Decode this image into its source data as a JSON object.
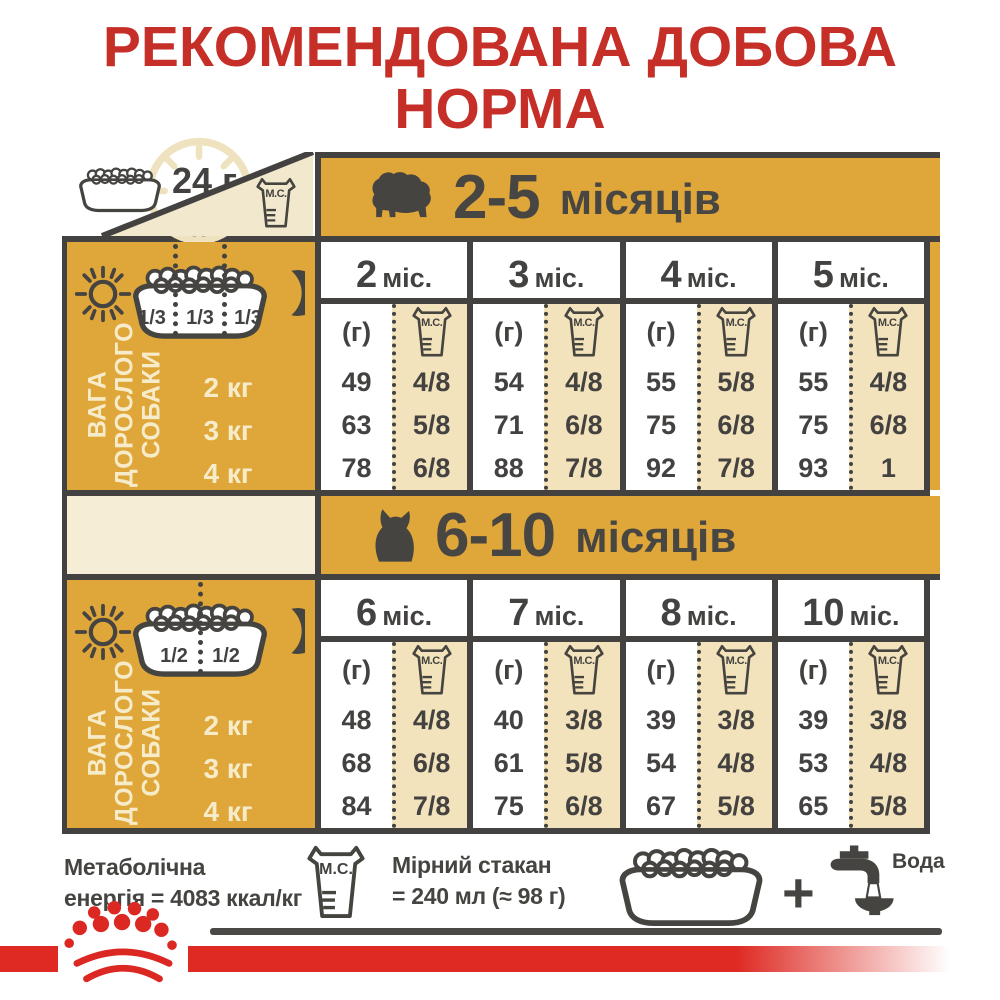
{
  "title": {
    "line1": "РЕКОМЕНДОВАНА ДОБОВА",
    "line2": "НОРМА"
  },
  "top": {
    "daily_label": "24 г"
  },
  "labels": {
    "mc": "М.С.",
    "grams": "(г)"
  },
  "colors": {
    "gold": "#DFA63A",
    "beige": "#F3E3BC",
    "dark": "#434240",
    "red_title": "#C62F28",
    "red_bar": "#DE2A23"
  },
  "sections": [
    {
      "range": "2-5",
      "unit": "місяців",
      "months": [
        {
          "n": "2",
          "u": "міс."
        },
        {
          "n": "3",
          "u": "міс."
        },
        {
          "n": "4",
          "u": "міс."
        },
        {
          "n": "5",
          "u": "міс."
        }
      ],
      "fractions": [
        "1/3",
        "1/3",
        "1/3"
      ],
      "weight_label": {
        "l1": "ВАГА",
        "l2": "ДОРОСЛОГО",
        "l3": "СОБАКИ"
      },
      "rows": [
        {
          "w": "2 кг",
          "c": [
            "49",
            "4/8",
            "54",
            "4/8",
            "55",
            "5/8",
            "55",
            "4/8"
          ]
        },
        {
          "w": "3 кг",
          "c": [
            "63",
            "5/8",
            "71",
            "6/8",
            "75",
            "6/8",
            "75",
            "6/8"
          ]
        },
        {
          "w": "4 кг",
          "c": [
            "78",
            "6/8",
            "88",
            "7/8",
            "92",
            "7/8",
            "93",
            "1"
          ]
        }
      ]
    },
    {
      "range": "6-10",
      "unit": "місяців",
      "months": [
        {
          "n": "6",
          "u": "міс."
        },
        {
          "n": "7",
          "u": "міс."
        },
        {
          "n": "8",
          "u": "міс."
        },
        {
          "n": "10",
          "u": "міс."
        }
      ],
      "fractions": [
        "1/2",
        "1/2"
      ],
      "weight_label": {
        "l1": "ВАГА",
        "l2": "ДОРОСЛОГО",
        "l3": "СОБАКИ"
      },
      "rows": [
        {
          "w": "2 кг",
          "c": [
            "48",
            "4/8",
            "40",
            "3/8",
            "39",
            "3/8",
            "39",
            "3/8"
          ]
        },
        {
          "w": "3 кг",
          "c": [
            "68",
            "6/8",
            "61",
            "5/8",
            "54",
            "4/8",
            "53",
            "4/8"
          ]
        },
        {
          "w": "4 кг",
          "c": [
            "84",
            "7/8",
            "75",
            "6/8",
            "67",
            "5/8",
            "65",
            "5/8"
          ]
        }
      ]
    }
  ],
  "footer": {
    "energy_l1": "Метаболічна",
    "energy_l2": "енергія = 4083 ккал/кг",
    "cup_l1": "Мірний стакан",
    "cup_l2": "= 240 мл (≈ 98 г)",
    "plus": "+",
    "water": "Вода"
  }
}
